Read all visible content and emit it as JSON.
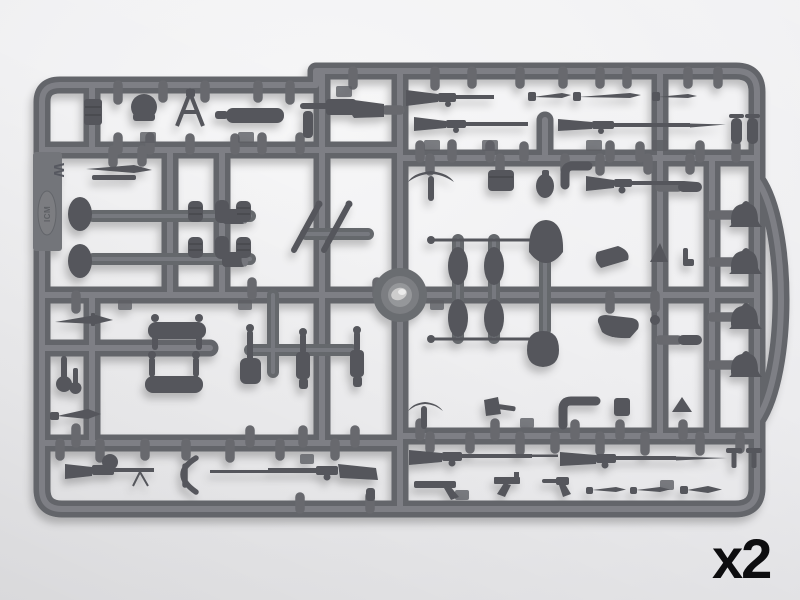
{
  "image": {
    "description": "Photograph of one injection-molded gray plastic sprue (parts frame) from a 1/35 scale WWI infantry weapons and equipment model kit, shot on a plain light background",
    "quantity_label": "x2",
    "sprue_marking": {
      "letter": "W",
      "brand": "ICM"
    },
    "colors": {
      "background": "#efeff1",
      "plastic_runner": "#63656a",
      "plastic_highlight": "#84868c",
      "plastic_part": "#54565b",
      "quantity_text": "#0d0d0f"
    },
    "parts_visible": [
      "ammo clip stack",
      "round holster pouch",
      "folding frame",
      "cylindrical case",
      "bayonet with scabbard",
      "submachine gun",
      "carbine",
      "bolt-action rifle",
      "bayonets",
      "long rifle with fixed bayonet",
      "flask pair",
      "pickaxe",
      "ammunition box",
      "stovepipe elbow",
      "rifle",
      "small canteen",
      "water-bottle capsules",
      "cleaning rods with ball tips",
      "round-blade shovels",
      "pistol holster",
      "adrian helmets",
      "oval canteens",
      "mugs",
      "grenade clusters",
      "diagonal bayonet scabbards",
      "wire cutters",
      "square spade",
      "two-handled trench spades",
      "combat knife",
      "stick grenade",
      "dagger",
      "drum-magazine machine gun",
      "wire frame",
      "long rifle with rod bayonet",
      "mauser pistols",
      "luger pistol",
      "hatchet",
      "grenade cup",
      "wedge parts",
      "t-pins",
      "center injection hub"
    ]
  }
}
